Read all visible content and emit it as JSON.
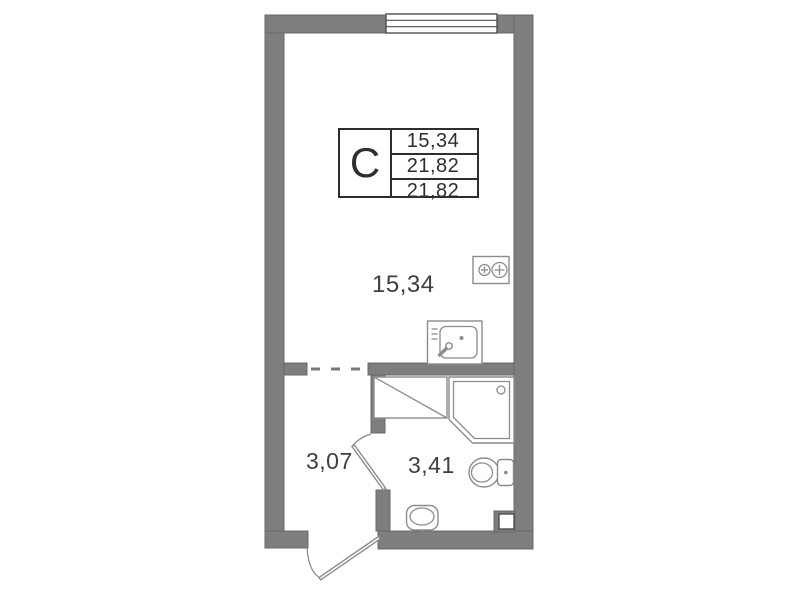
{
  "legend": {
    "type_label": "С",
    "values": [
      "15,34",
      "21,82",
      "21,82"
    ]
  },
  "rooms": {
    "living": {
      "area": "15,34"
    },
    "hallway": {
      "area": "3,07"
    },
    "bathroom": {
      "area": "3,41"
    }
  },
  "icons": {
    "stove": "stove-two-burners-icon",
    "kitchen_sink": "kitchen-sink-icon",
    "washing_machine": "washing-machine-area",
    "shower": "shower-cabin-icon",
    "toilet": "toilet-icon",
    "washbasin": "washbasin-icon",
    "window": "window-icon",
    "vent": "vent-shaft-icon"
  },
  "colors": {
    "bg": "#ffffff",
    "wall": "#7e7e7e",
    "wall_edge": "#686868",
    "fixture": "#8c8c8c",
    "outline_dark": "#4f4f4f",
    "outline_legend": "#2e2e2e",
    "text": "#3f3f3f",
    "dash": "#7a7a7a"
  }
}
